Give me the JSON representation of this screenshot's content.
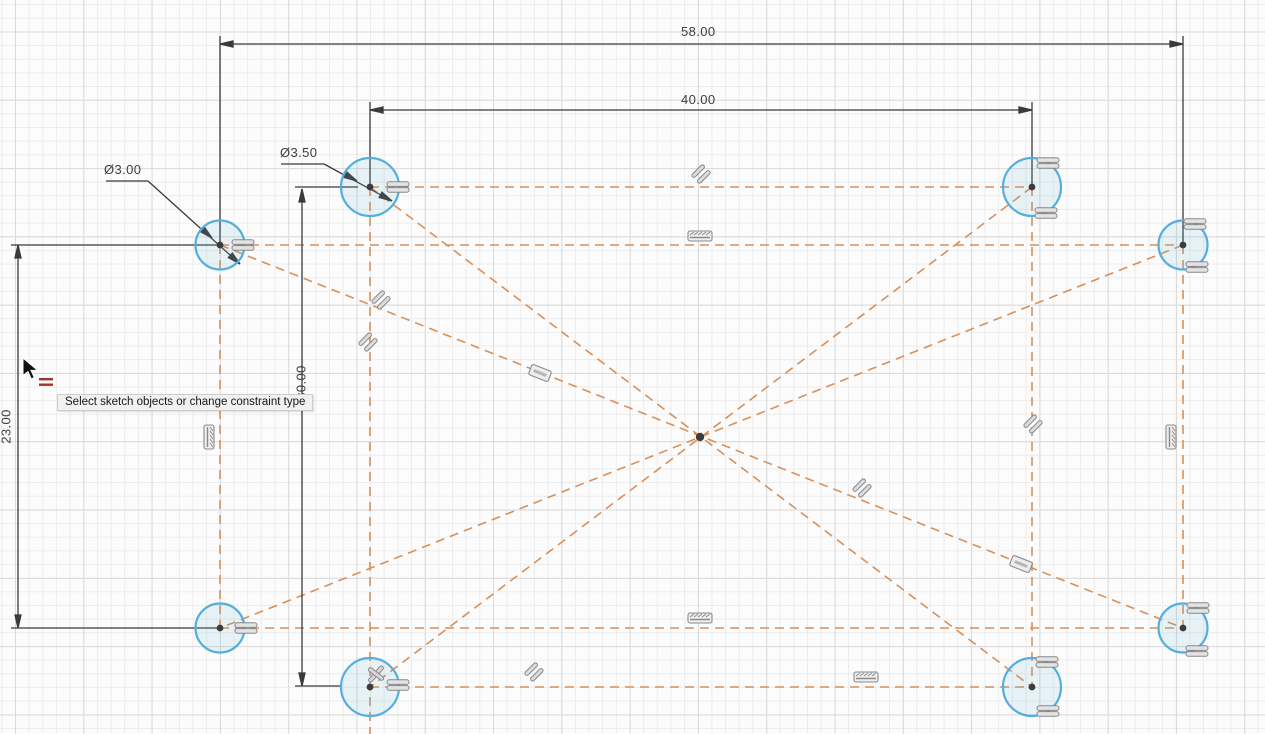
{
  "app": {
    "view": "cad-sketch-canvas",
    "status_tooltip": "Select sketch objects or change constraint type"
  },
  "dimension_labels": {
    "outer_width": "58.00",
    "inner_width": "40.00",
    "left_height": "23.00",
    "inner_height": "30.00",
    "small_hole_diameter": "Ø3.00",
    "large_hole_diameter": "Ø3.50"
  },
  "sketch": {
    "circle_count": 8,
    "hole_diameters_mm": [
      3.0,
      3.5
    ],
    "rectangle_widths_mm": [
      58,
      40
    ],
    "rectangle_heights_mm": [
      23,
      30
    ]
  },
  "icons": {
    "cursor": "arrow-cursor-icon",
    "cursor_badge": "equal-constraint-cursor-icon",
    "constraint_equal": "equal-constraint-icon",
    "constraint_parallel": "parallel-constraint-icon",
    "constraint_collinear": "collinear-constraint-icon",
    "constraint_midline": "online-constraint-icon",
    "constraint_cross": "crossed-constraint-icon"
  },
  "colors": {
    "construction_line": "#D8905A",
    "dimension_line": "#3A3A3A",
    "circle_stroke": "#55AEDC",
    "circle_fill": "rgba(90,175,220,0.13)",
    "constraint_icon_stroke": "#878787",
    "constraint_icon_fill": "#E3E3E3",
    "cursor_badge_red": "#A03434",
    "grid_minor": "#ECECEC",
    "grid_major": "#DADADA"
  }
}
